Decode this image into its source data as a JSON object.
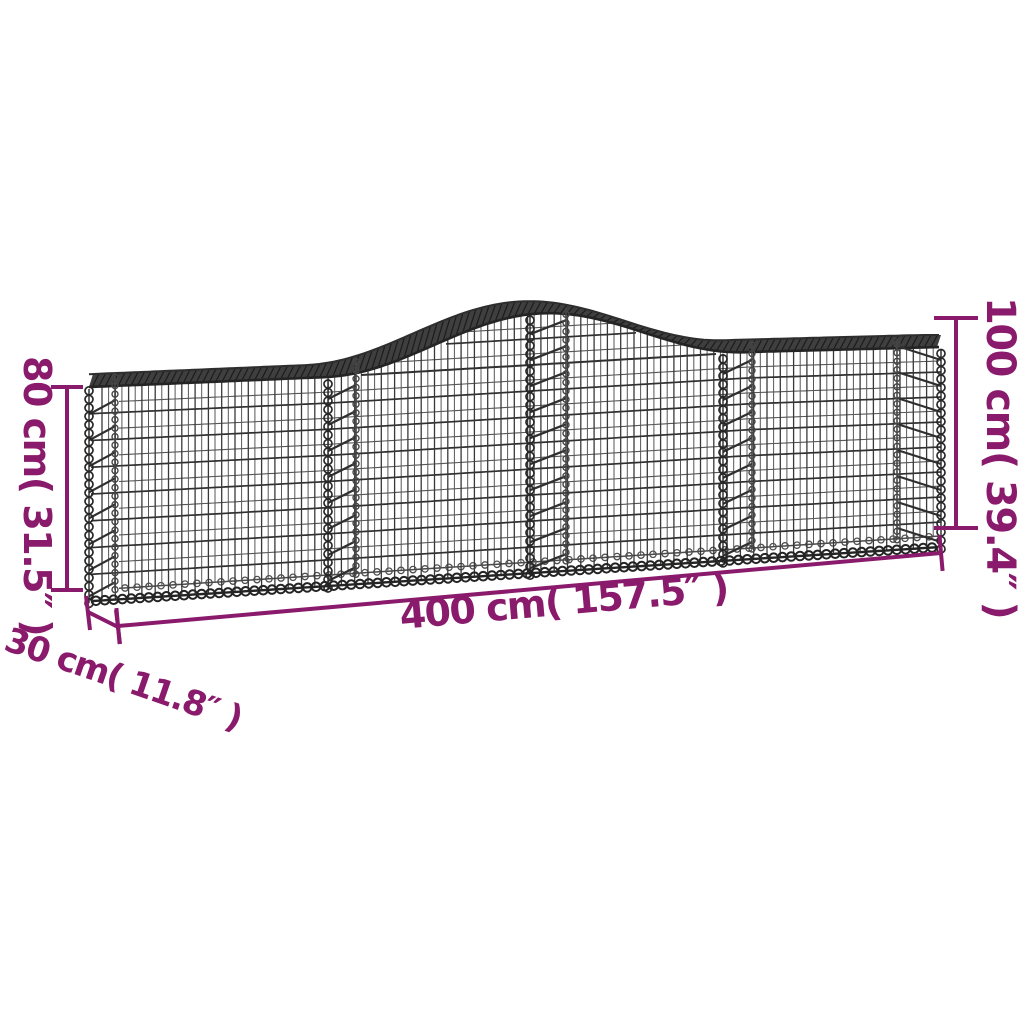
{
  "diagram": {
    "type": "product-dimension-diagram",
    "subject": "arched-gabion-mesh-basket",
    "colors": {
      "accent": "#8a1a6b",
      "background": "#ffffff",
      "wire_dark": "#242424",
      "wire": "#333333",
      "wire_light": "#575757",
      "band_fill": "#3f3f3f"
    },
    "dimensions": {
      "height_left": {
        "label": "80 cm( 31.5″ )",
        "value_cm": 80,
        "value_in": 31.5
      },
      "height_right": {
        "label": "100 cm( 39.4″ )",
        "value_cm": 100,
        "value_in": 39.4
      },
      "length": {
        "label": "400 cm( 157.5″ )",
        "value_cm": 400,
        "value_in": 157.5
      },
      "depth": {
        "label": "30 cm( 11.8″ )",
        "value_cm": 30,
        "value_in": 11.8
      }
    }
  }
}
